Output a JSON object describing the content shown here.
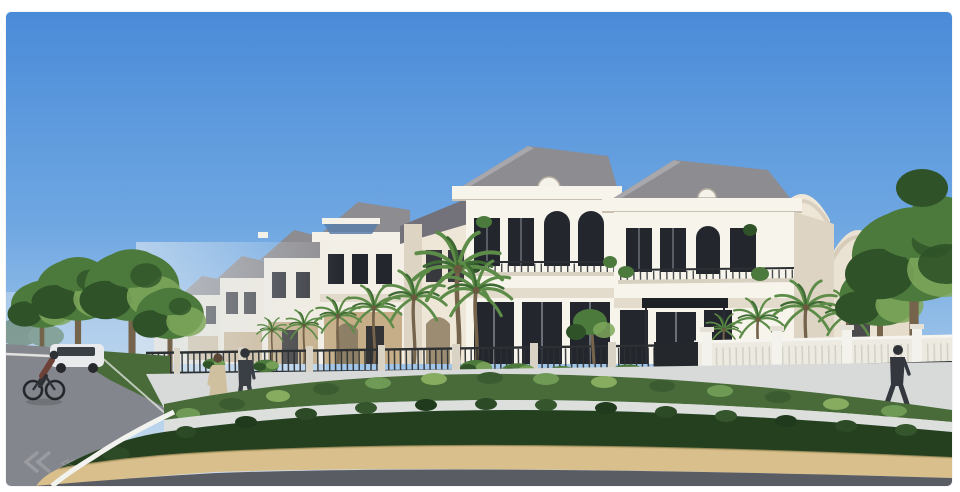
{
  "image": {
    "kind": "architectural-render",
    "watermark": {
      "icon": "double-chevron-left-watermark-icon",
      "glyph": "≪"
    }
  },
  "colors": {
    "sky_top": "#4a8bd8",
    "sky_mid": "#6fa7e2",
    "sky_low": "#a6c9ea",
    "sky_horizon": "#d3e2f0",
    "facade_white": "#f7f4ec",
    "facade_cream": "#eee7d8",
    "facade_shadow": "#ddd4c3",
    "stone_tan": "#c6ae88",
    "roof_grey": "#8d8c90",
    "roof_dark": "#73727a",
    "window_dark": "#23262d",
    "trim_dark": "#2c3033",
    "pergola_blue": "#5b7fa8",
    "foliage_dark": "#2f5228",
    "foliage_mid": "#4c7a3c",
    "foliage_light": "#7fa85c",
    "palm_green": "#5d8c48",
    "palm_dark": "#3e6a33",
    "hedge_dark": "#25401f",
    "shrub_green": "#486b39",
    "sidewalk_light": "#d7dad8",
    "path_light": "#dcdfdc",
    "curb_tan": "#d8bf8c",
    "road_dark": "#5a5c63",
    "road_left": "#83868c",
    "fence_white": "#edeae2",
    "trunk_brown": "#75634b",
    "white_line": "#f2f2ef",
    "skin_tone": "#caa183",
    "dress_beige": "#cfc0a0",
    "suit_dark": "#3a3e45",
    "car_white": "#e9eaec"
  }
}
